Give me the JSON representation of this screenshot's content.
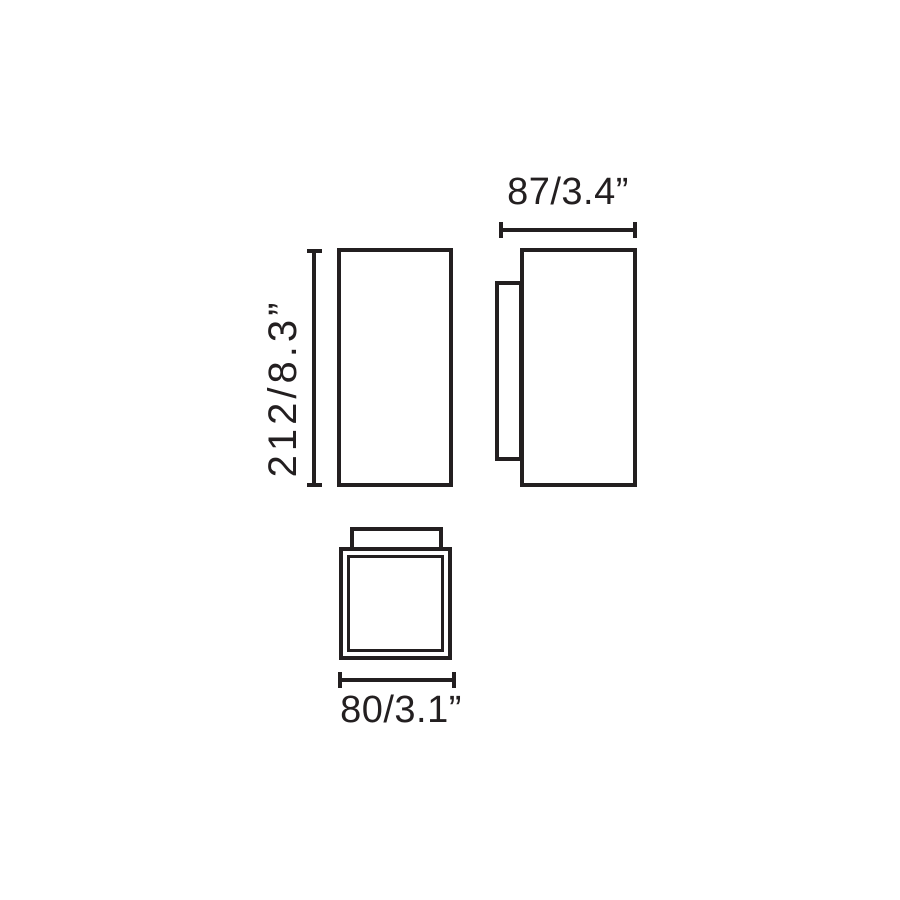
{
  "diagram": {
    "type": "product-dimension-drawing",
    "background_color": "#ffffff",
    "line_color": "#231f20",
    "views": [
      "front",
      "side",
      "bottom"
    ],
    "dimensions": {
      "height_mm_in": "212/8.3”",
      "depth_mm_in": "87/3.4”",
      "width_mm_in": "80/3.1”"
    }
  }
}
